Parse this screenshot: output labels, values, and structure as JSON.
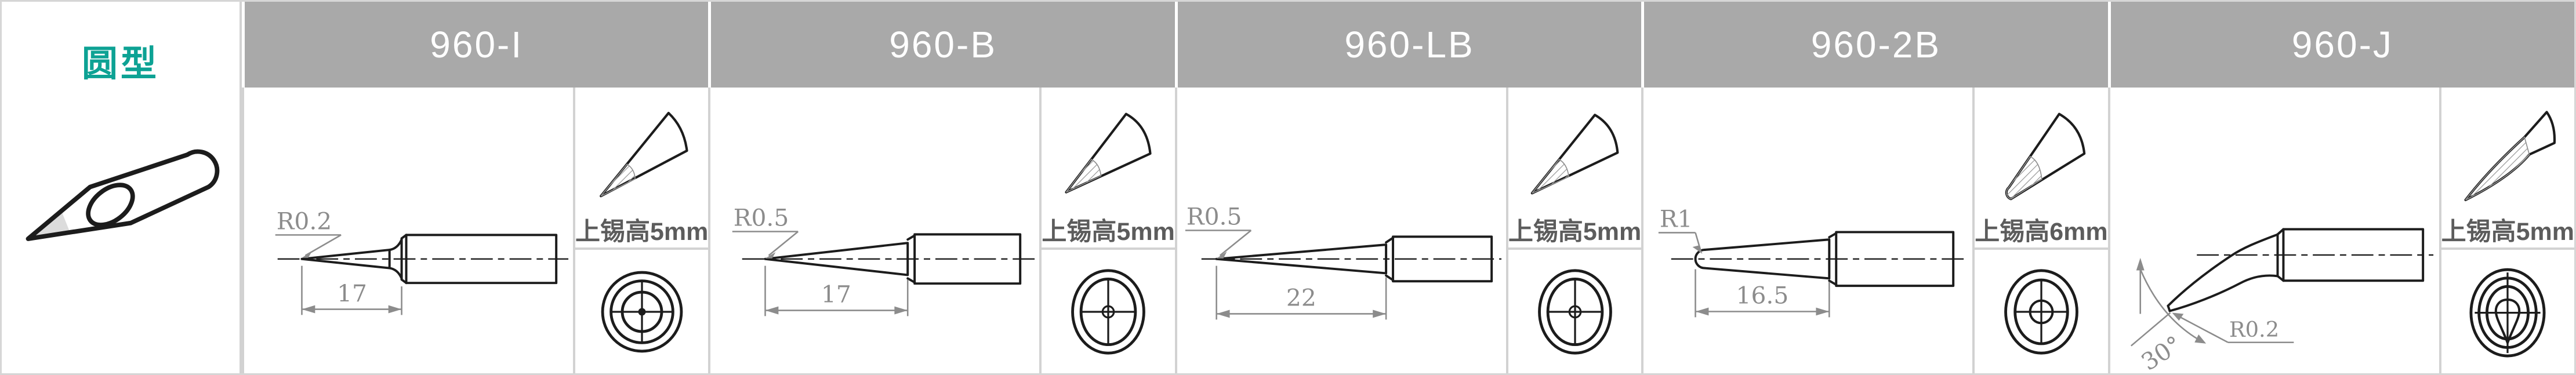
{
  "colors": {
    "teal": "#0da294",
    "header-bg": "#a9a9a9",
    "header-text": "#ffffff",
    "border": "#d2d2d2",
    "outer-border": "#d6d6d6",
    "line": "#1c1c1c",
    "dim": "#8c8c8c",
    "cn-text": "#5c5c5c",
    "tip-shade": "#dcdcdc"
  },
  "category": {
    "label": "圆型"
  },
  "columns": [
    {
      "model": "960-I",
      "radius_label": "R0.2",
      "length_label": "17",
      "tin_label": "上锡高5mm"
    },
    {
      "model": "960-B",
      "radius_label": "R0.5",
      "length_label": "17",
      "tin_label": "上锡高5mm"
    },
    {
      "model": "960-LB",
      "radius_label": "R0.5",
      "length_label": "22",
      "tin_label": "上锡高5mm"
    },
    {
      "model": "960-2B",
      "radius_label": "R1",
      "length_label": "16.5",
      "tin_label": "上锡高6mm"
    },
    {
      "model": "960-J",
      "radius_label": "R0.2",
      "angle_label": "30°",
      "tin_label": "上锡高5mm"
    }
  ]
}
